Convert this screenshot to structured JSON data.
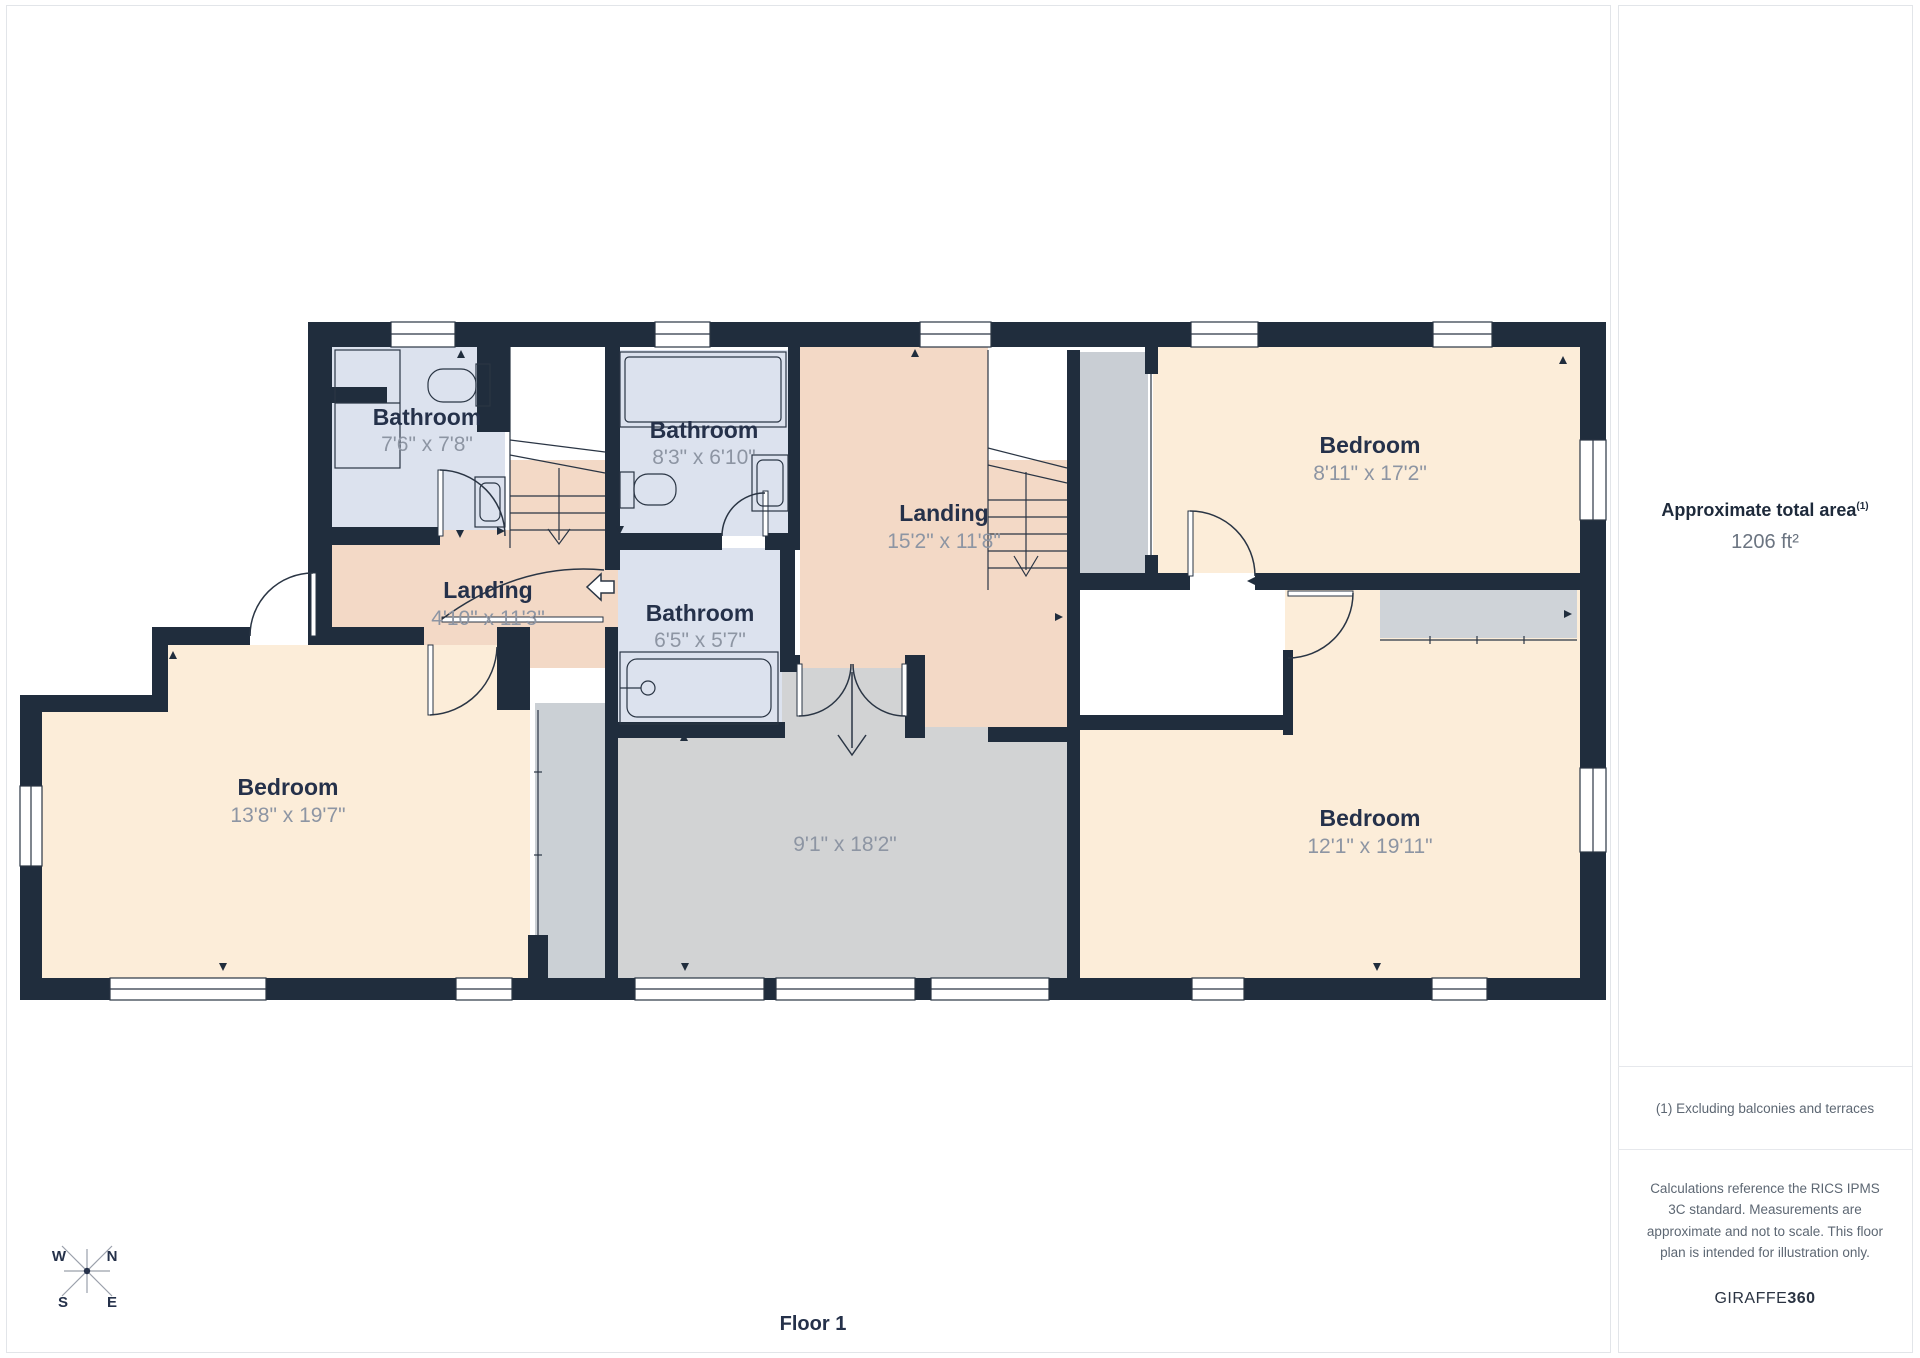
{
  "plan": {
    "floor_label": "Floor 1",
    "compass": {
      "north": "N",
      "south": "S",
      "east": "E",
      "west": "W"
    },
    "rooms": {
      "bathroom_a": {
        "name": "Bathroom",
        "dims": "7'6\" x 7'8\""
      },
      "bathroom_b": {
        "name": "Bathroom",
        "dims": "8'3\" x 6'10\""
      },
      "bathroom_c": {
        "name": "Bathroom",
        "dims": "6'5\" x 5'7\""
      },
      "landing_a": {
        "name": "Landing",
        "dims": "4'10\" x 11'3\""
      },
      "landing_b": {
        "name": "Landing",
        "dims": "15'2\" x 11'8\""
      },
      "bedroom_top_right": {
        "name": "Bedroom",
        "dims": "8'11\" x 17'2\""
      },
      "bedroom_bottom_left": {
        "name": "Bedroom",
        "dims": "13'8\" x 19'7\""
      },
      "bedroom_bottom_right": {
        "name": "Bedroom",
        "dims": "12'1\" x 19'11\""
      },
      "unlabeled_room": {
        "dims": "9'1\" x 18'2\""
      }
    }
  },
  "sidebar": {
    "area_title": "Approximate total area",
    "area_title_superscript": "(1)",
    "area_value": "1206 ft²",
    "footnote": "(1) Excluding balconies and terraces",
    "disclaimer": "Calculations reference the RICS IPMS 3C standard. Measurements are approximate and not to scale. This floor plan is intended for illustration only.",
    "brand": {
      "name": "GIRAFFE",
      "suffix": "360"
    }
  },
  "colors": {
    "wall": "#202d3d",
    "bedroom_fill": "#fcedd9",
    "landing_fill": "#f3d9c6",
    "bathroom_fill": "#dce2ee",
    "gray_room_fill": "#d2d3d4",
    "closet_fill": "#cbd0d5",
    "room_name_text": "#25314a",
    "room_dims_text": "#8d95a3"
  }
}
